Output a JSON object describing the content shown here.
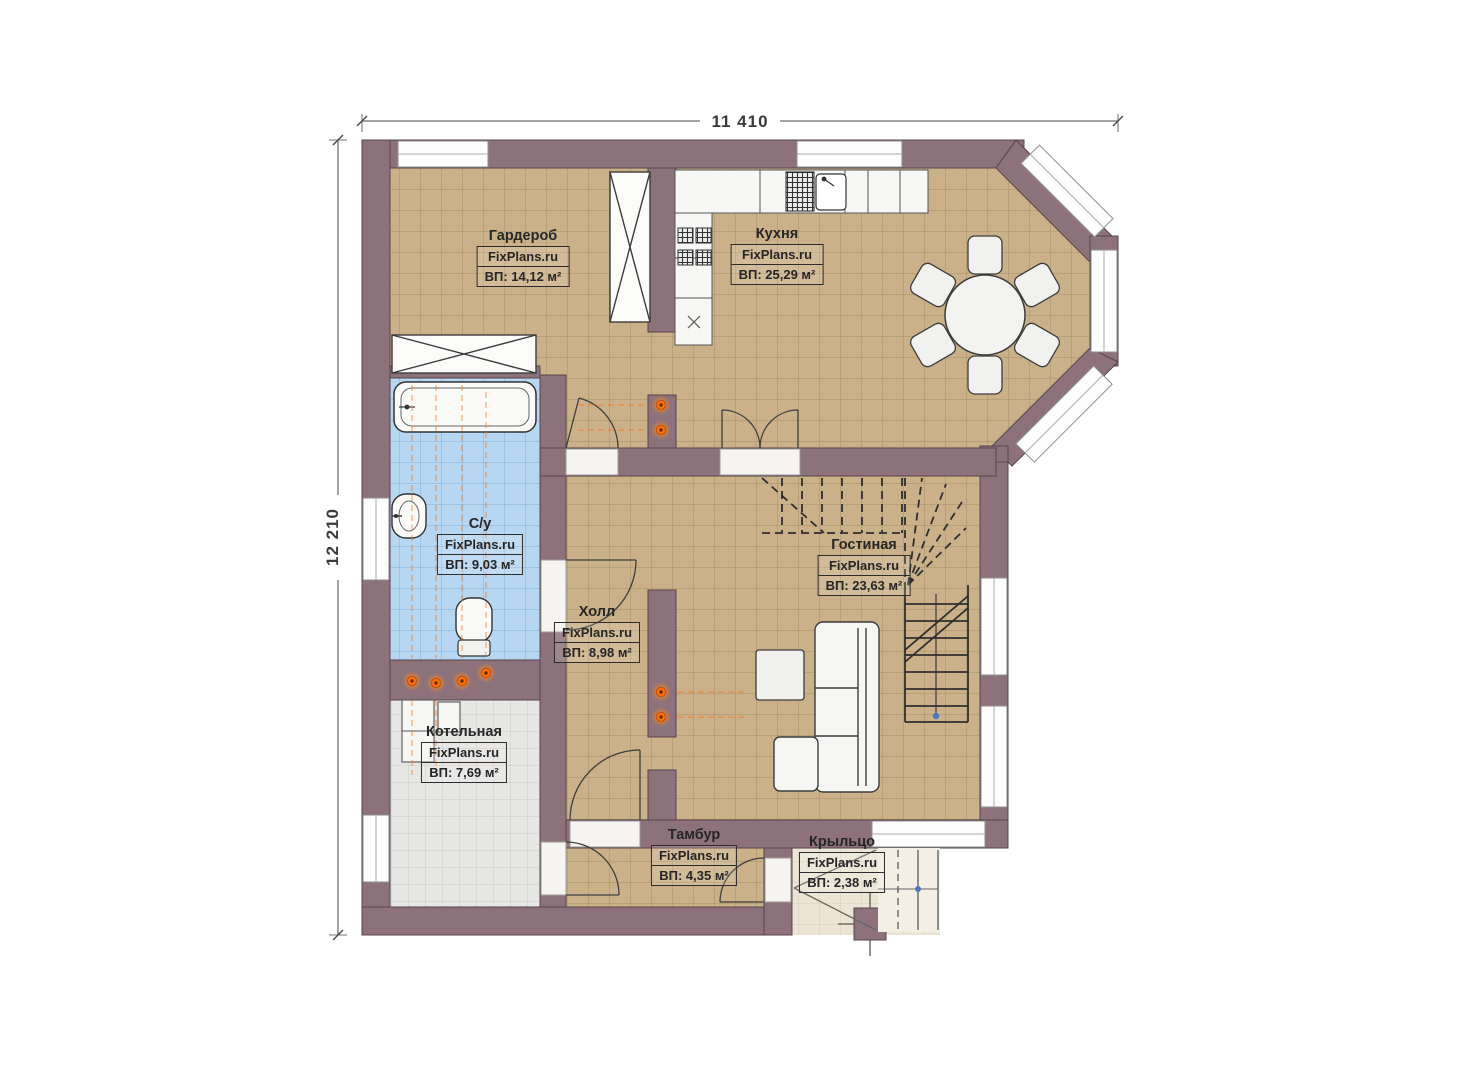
{
  "plan": {
    "dimensions": {
      "width": "11 410",
      "height": "12 210"
    },
    "watermark": "FixPlans.ru",
    "rooms": [
      {
        "name": "Гардероб",
        "area": "ВП: 14,12 м²"
      },
      {
        "name": "Кухня",
        "area": "ВП: 25,29 м²"
      },
      {
        "name": "С/у",
        "area": "ВП: 9,03 м²"
      },
      {
        "name": "Гостиная",
        "area": "ВП: 23,63 м²"
      },
      {
        "name": "Холл",
        "area": "ВП: 8,98 м²"
      },
      {
        "name": "Котельная",
        "area": "ВП: 7,69 м²"
      },
      {
        "name": "Тамбур",
        "area": "ВП: 4,35 м²"
      },
      {
        "name": "Крыльцо",
        "area": "ВП: 2,38 м²"
      }
    ],
    "colors": {
      "wall": "#8d727b",
      "floor_beige": "#cab189",
      "floor_blue": "#b7d6f2",
      "floor_gray": "#e6e6e4",
      "floor_cream": "#ece5d6",
      "accent_orange": "#ff700a",
      "marker_blue": "#5176c0"
    }
  }
}
